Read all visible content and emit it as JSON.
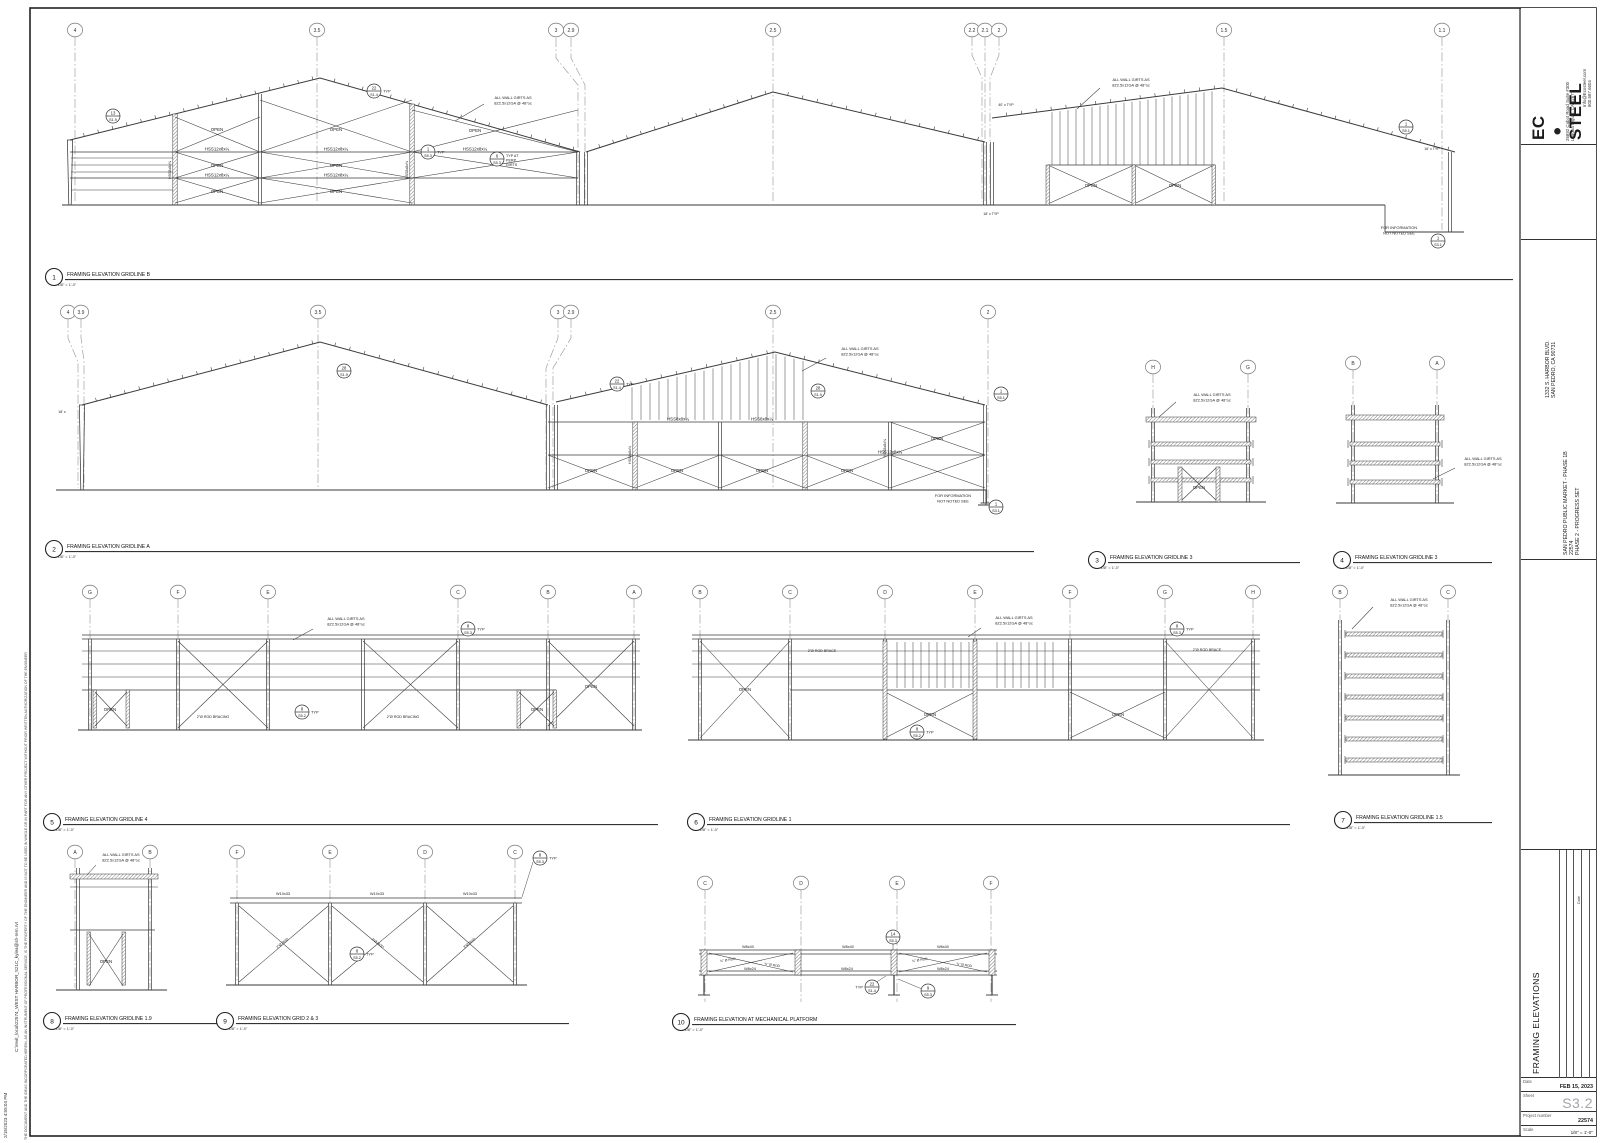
{
  "sheet": {
    "line_color": "#3a3a3a",
    "grid_color": "#9a9a9a",
    "paper": "#ffffff"
  },
  "edge": {
    "print_datetime": "2/15/2023 4:55:04 PM",
    "file_path": "C:\\revit_local\\22574_WEST HARBOR_S21C_kylea@sh-rem.rvt",
    "disclaimer": "THE DOCUMENT AND THE IDEAS INCORPORATED HEREIN, AS AN INSTRUMENT OF PROFESSIONAL SERVICE, IS THE PROPERTY OF THE ENGINEER AND IS NOT TO BE USED IN WHOLE OR IN PART FOR ANY OTHER PROJECT WITHOUT PRIOR WRITTEN AUTHORIZATION OF THE ENGINEER"
  },
  "titleblock": {
    "logo": {
      "prefix": "EC",
      "suffix": "STEEL"
    },
    "address_line1": "26892 Cabot Road Suite #300",
    "address_line2": "Laguna Niguel, CA 92677",
    "contact_line1": "Info@Ecosteel.com",
    "contact_line2": "800.587.6604",
    "project_address1": "1332 S. HARBOR BLVD.",
    "project_address2": "SAN PEDRO, CA 90731",
    "project_name": "SAN PEDRO PUBLIC MARKET - PHASE 1B",
    "project_code": "22574",
    "project_phase": "PHASE 2 - PROGRESS SET",
    "revision_col_label": "Date",
    "sheet_title": "FRAMING ELEVATIONS",
    "fields": {
      "date_label": "Date",
      "date_value": "FEB 15, 2023",
      "sheet_label": "Sheet",
      "sheet_value": "S3.2",
      "project_label": "Project number",
      "project_value": "22574",
      "scale_label": "Scale",
      "scale_value": "1/8\" = 1'-0\""
    }
  },
  "drawings": [
    {
      "num": "1",
      "title": "FRAMING ELEVATION GRIDLINE B",
      "scale": "1/8\" = 1'-0\"",
      "cx": 54,
      "cy": 277,
      "ux": 1513
    },
    {
      "num": "2",
      "title": "FRAMING ELEVATION GRIDLINE A",
      "scale": "1/8\" = 1'-0\"",
      "cx": 54,
      "cy": 549,
      "ux": 1034
    },
    {
      "num": "3",
      "title": "FRAMING ELEVATION GRIDLINE 3",
      "scale": "1/8\" = 1'-0\"",
      "cx": 1097,
      "cy": 560,
      "ux": 1300
    },
    {
      "num": "4",
      "title": "FRAMING ELEVATION GRIDLINE 3",
      "scale": "1/8\" = 1'-0\"",
      "cx": 1342,
      "cy": 560,
      "ux": 1492
    },
    {
      "num": "5",
      "title": "FRAMING ELEVATION GRIDLINE 4",
      "scale": "1/8\" = 1'-0\"",
      "cx": 52,
      "cy": 822,
      "ux": 658
    },
    {
      "num": "6",
      "title": "FRAMING ELEVATION GRIDLINE 1",
      "scale": "1/8\" = 1'-0\"",
      "cx": 696,
      "cy": 822,
      "ux": 1290
    },
    {
      "num": "7",
      "title": "FRAMING ELEVATION GRIDLINE 1.5",
      "scale": "1/8\" = 1'-0\"",
      "cx": 1343,
      "cy": 820,
      "ux": 1492
    },
    {
      "num": "8",
      "title": "FRAMING ELEVATION GRIDLINE 1.9",
      "scale": "1/8\" = 1'-0\"",
      "cx": 52,
      "cy": 1021,
      "ux": 228
    },
    {
      "num": "9",
      "title": "FRAMING ELEVATION GRID 2 & 3",
      "scale": "1/8\" = 1'-0\"",
      "cx": 225,
      "cy": 1021,
      "ux": 569
    },
    {
      "num": "10",
      "title": "FRAMING ELEVATION AT MECHANICAL PLATFORM",
      "scale": "1/8\" = 1'-0\"",
      "cx": 681,
      "cy": 1022,
      "ux": 1016
    }
  ],
  "annotations": {
    "e1": {
      "bubbles": [
        [
          "4",
          75,
          30
        ],
        [
          "3.5",
          317,
          30
        ],
        [
          "3",
          556,
          30
        ],
        [
          "2.9",
          571,
          30
        ],
        [
          "2.5",
          773,
          30
        ],
        [
          "2.2",
          972,
          30
        ],
        [
          "2.1",
          985,
          30
        ],
        [
          "2",
          999,
          30
        ],
        [
          "1.5",
          1224,
          30
        ],
        [
          "1.1",
          1442,
          30
        ]
      ],
      "labels": [
        [
          "OPEN",
          217,
          131
        ],
        [
          "OPEN",
          336,
          131
        ],
        [
          "OPEN",
          475,
          132
        ],
        [
          "OPEN",
          217,
          167
        ],
        [
          "OPEN",
          336,
          167
        ],
        [
          "OPEN",
          217,
          193
        ],
        [
          "OPEN",
          336,
          193
        ],
        [
          "OPEN",
          1091,
          187
        ],
        [
          "OPEN",
          1175,
          187
        ],
        [
          "HSS12x8x¼",
          217,
          150.5
        ],
        [
          "HSS12x8x¼",
          336,
          150.5
        ],
        [
          "HSS12x8x¼",
          475,
          150.5
        ],
        [
          "HSS12x8x¼",
          217,
          176.5
        ],
        [
          "HSS12x8x¼",
          336,
          176.5
        ],
        [
          "HSS8x8x⅜",
          171,
          170,
          3.6,
          -90
        ],
        [
          "HSS8x8x⅜",
          408,
          170,
          3.6,
          -90
        ],
        [
          "40' x TYP",
          1006,
          106,
          3.6
        ],
        [
          "18' x TYP",
          991,
          215,
          3.6
        ],
        [
          "16' x TYP",
          1432,
          150,
          3.6
        ]
      ],
      "callouts": [
        {
          "x": 113,
          "y": 116,
          "top": "13",
          "bot": "S1.9"
        },
        {
          "x": 374,
          "y": 91,
          "top": "22",
          "bot": "S1.4",
          "suf": "TYP"
        },
        {
          "x": 428,
          "y": 152,
          "top": "1",
          "bot": "S5.3",
          "suf": "TYP"
        },
        {
          "x": 497,
          "y": 159,
          "top": "6",
          "bot": "S5.3",
          "lines": [
            "TYP AT",
            "PERP",
            "GIRTS"
          ]
        },
        {
          "x": 1406,
          "y": 127,
          "top": "1",
          "bot": "S5.1"
        },
        {
          "x": 1438,
          "y": 241,
          "top": "1",
          "bot": "S3.1"
        }
      ],
      "notes": [
        {
          "lines": [
            "ALL WALL GIRTS AS",
            "8Z2.5x12GA @ 48\"oc"
          ],
          "x": 513,
          "y": 99,
          "leader": [
            [
              484,
              104
            ],
            [
              455,
              121
            ]
          ]
        },
        {
          "lines": [
            "ALL WALL GIRTS AS",
            "8Z2.5x12GA @ 48\"oc"
          ],
          "x": 1131,
          "y": 81,
          "leader": [
            [
              1100,
              88
            ],
            [
              1077,
              109
            ]
          ]
        },
        {
          "lines": [
            "FOR INFORMATION",
            "NOT NOTED SEE"
          ],
          "x": 1399,
          "y": 229
        }
      ]
    },
    "e2": {
      "bubbles": [
        [
          "4",
          68,
          312
        ],
        [
          "3.9",
          81,
          312
        ],
        [
          "3.5",
          318,
          312
        ],
        [
          "3",
          558,
          312
        ],
        [
          "2.9",
          571,
          312
        ],
        [
          "2.5",
          773,
          312
        ],
        [
          "2",
          988,
          312
        ]
      ],
      "labels": [
        [
          "OPEN",
          591,
          472
        ],
        [
          "OPEN",
          677,
          472
        ],
        [
          "OPEN",
          762,
          472
        ],
        [
          "OPEN",
          847,
          472
        ],
        [
          "OPEN",
          937,
          440
        ],
        [
          "HSS8x8x¼",
          678,
          420.5
        ],
        [
          "HSS8x8x¼",
          762,
          420.5
        ],
        [
          "HSS12x8x¼",
          890,
          453.5
        ],
        [
          "HSS8x8x⅜",
          631,
          455,
          3.6,
          -90
        ],
        [
          "HSS8x8x⅜",
          886,
          448,
          3.6,
          -90
        ],
        [
          "18' x",
          62,
          413,
          3.6
        ]
      ],
      "callouts": [
        {
          "x": 344,
          "y": 371,
          "top": "28",
          "bot": "S1.9"
        },
        {
          "x": 617,
          "y": 384,
          "top": "22",
          "bot": "S1.4",
          "suf": "TYP"
        },
        {
          "x": 818,
          "y": 391,
          "top": "28",
          "bot": "S1.9"
        },
        {
          "x": 1001,
          "y": 394,
          "top": "1",
          "bot": "S5.1"
        },
        {
          "x": 996,
          "y": 507,
          "top": "1",
          "bot": "S3.1"
        }
      ],
      "notes": [
        {
          "lines": [
            "ALL WALL GIRTS AS",
            "8Z2.5x12GA @ 48\"oc"
          ],
          "x": 860,
          "y": 350,
          "leader": [
            [
              826,
              358
            ],
            [
              802,
              371
            ]
          ]
        },
        {
          "lines": [
            "FOR INFORMATION",
            "NOT NOTED SEE"
          ],
          "x": 953,
          "y": 497
        }
      ]
    },
    "e3": {
      "bubbles": [
        [
          "H",
          1153,
          367
        ],
        [
          "G",
          1248,
          367
        ]
      ],
      "labels": [
        [
          "OPEN",
          1199,
          489
        ]
      ],
      "callouts": [],
      "notes": [
        {
          "lines": [
            "ALL WALL GIRTS AS",
            "8Z2.5x12GA @ 48\"oc"
          ],
          "x": 1212,
          "y": 396,
          "leader": [
            [
              1176,
              402
            ],
            [
              1159,
              417
            ]
          ]
        }
      ]
    },
    "e4": {
      "bubbles": [
        [
          "B",
          1353,
          363
        ],
        [
          "A",
          1437,
          363
        ]
      ],
      "labels": [],
      "callouts": [],
      "notes": [
        {
          "lines": [
            "ALL WALL GIRTS AS",
            "8Z2.5x12GA @ 48\"oc"
          ],
          "x": 1483,
          "y": 460,
          "leader": [
            [
              1455,
              468
            ],
            [
              1433,
              479
            ]
          ]
        }
      ]
    },
    "e5": {
      "bubbles": [
        [
          "G",
          90,
          592
        ],
        [
          "F",
          178,
          592
        ],
        [
          "E",
          268,
          592
        ],
        [
          "C",
          458,
          592
        ],
        [
          "B",
          548,
          592
        ],
        [
          "A",
          634,
          592
        ]
      ],
      "labels": [
        [
          "OPEN",
          110,
          711
        ],
        [
          "OPEN",
          537,
          711
        ],
        [
          "OPEN",
          591,
          688
        ],
        [
          "2\"Ø ROD BRACING",
          213,
          718,
          3.6
        ],
        [
          "2\"Ø ROD BRACING",
          403,
          718,
          3.6
        ]
      ],
      "callouts": [
        {
          "x": 468,
          "y": 629,
          "top": "8",
          "bot": "S5.3",
          "suf": "TYP"
        },
        {
          "x": 302,
          "y": 712,
          "top": "8",
          "bot": "S5.2",
          "suf": "TYP"
        }
      ],
      "notes": [
        {
          "lines": [
            "ALL WALL GIRTS AS",
            "8Z2.5x12GA @ 48\"oc"
          ],
          "x": 346,
          "y": 620,
          "leader": [
            [
              313,
              629
            ],
            [
              293,
              640
            ]
          ]
        }
      ]
    },
    "e6": {
      "bubbles": [
        [
          "B",
          700,
          592
        ],
        [
          "C",
          790,
          592
        ],
        [
          "D",
          885,
          592
        ],
        [
          "E",
          975,
          592
        ],
        [
          "F",
          1070,
          592
        ],
        [
          "G",
          1165,
          592
        ],
        [
          "H",
          1253,
          592
        ]
      ],
      "labels": [
        [
          "OPEN",
          745,
          691
        ],
        [
          "OPEN",
          930,
          716
        ],
        [
          "OPEN",
          1118,
          716
        ],
        [
          "2\"Ø ROD BRACE",
          822,
          652,
          3.6
        ],
        [
          "2\"Ø ROD BRACE",
          1207,
          651,
          3.6
        ]
      ],
      "callouts": [
        {
          "x": 1177,
          "y": 629,
          "top": "8",
          "bot": "S5.3",
          "suf": "TYP"
        },
        {
          "x": 917,
          "y": 732,
          "top": "8",
          "bot": "S5.2",
          "suf": "TYP"
        }
      ],
      "notes": [
        {
          "lines": [
            "ALL WALL GIRTS AS",
            "8Z2.5x12GA @ 48\"oc"
          ],
          "x": 1014,
          "y": 619,
          "leader": [
            [
              981,
              628
            ],
            [
              968,
              637
            ]
          ]
        }
      ]
    },
    "e7": {
      "bubbles": [
        [
          "B",
          1340,
          592
        ],
        [
          "C",
          1448,
          592
        ]
      ],
      "labels": [],
      "callouts": [],
      "notes": [
        {
          "lines": [
            "ALL WALL GIRTS AS",
            "8Z2.5x12GA @ 48\"oc"
          ],
          "x": 1409,
          "y": 601,
          "leader": [
            [
              1373,
              607
            ],
            [
              1352,
              629
            ]
          ]
        }
      ]
    },
    "e8": {
      "bubbles": [
        [
          "A",
          75,
          852
        ],
        [
          "B",
          150,
          852
        ]
      ],
      "labels": [
        [
          "OPEN",
          106,
          963
        ]
      ],
      "callouts": [],
      "notes": [
        {
          "lines": [
            "ALL WALL GIRTS AS",
            "8Z2.5x12GA @ 48\"oc"
          ],
          "x": 121,
          "y": 856,
          "leader": [
            [
              96,
              865
            ],
            [
              87,
              875
            ]
          ]
        }
      ]
    },
    "e9": {
      "bubbles": [
        [
          "F",
          237,
          852
        ],
        [
          "E",
          330,
          852
        ],
        [
          "D",
          425,
          852
        ],
        [
          "C",
          515,
          852
        ]
      ],
      "labels": [
        [
          "W10x33",
          283,
          895,
          3.8
        ],
        [
          "W10x33",
          377,
          895,
          3.8
        ],
        [
          "W10x33",
          470,
          895,
          3.8
        ],
        [
          "2\"Ø ROD",
          283,
          944,
          3.5,
          -38
        ],
        [
          "3\"Ø ROD",
          377,
          944,
          3.5,
          38
        ],
        [
          "3\"Ø ROD",
          470,
          944,
          3.5,
          -38
        ]
      ],
      "callouts": [
        {
          "x": 357,
          "y": 954,
          "top": "8",
          "bot": "S5.2",
          "suf": "TYP"
        },
        {
          "x": 540,
          "y": 858,
          "top": "8",
          "bot": "S5.3",
          "suf": "TYP"
        }
      ],
      "notes": []
    },
    "e10": {
      "bubbles": [
        [
          "C",
          705,
          883
        ],
        [
          "D",
          801,
          883
        ],
        [
          "E",
          897,
          883
        ],
        [
          "F",
          991,
          883
        ]
      ],
      "labels": [
        [
          "W8x40",
          748,
          948,
          3.8
        ],
        [
          "W8x40",
          848,
          948,
          3.8
        ],
        [
          "W8x40",
          943,
          948,
          3.8
        ],
        [
          "W8x24",
          750,
          970,
          3.8
        ],
        [
          "W8x24",
          847,
          970,
          3.8
        ],
        [
          "W8x24",
          943,
          970,
          3.8
        ],
        [
          "¾\" Ø ROD",
          728,
          961,
          3.3,
          -9
        ],
        [
          "¾\" Ø ROD",
          772,
          966,
          3.3,
          9
        ],
        [
          "¾\" Ø ROD",
          920,
          961,
          3.3,
          -9
        ],
        [
          "¾\" Ø ROD",
          964,
          966,
          3.3,
          9
        ]
      ],
      "callouts": [
        {
          "x": 893,
          "y": 937,
          "top": "14",
          "bot": "S5.3"
        },
        {
          "x": 872,
          "y": 987,
          "top": "22",
          "bot": "S1.4",
          "pre": "TYP"
        },
        {
          "x": 928,
          "y": 991,
          "top": "9",
          "bot": "S5.3"
        }
      ],
      "notes": []
    }
  }
}
